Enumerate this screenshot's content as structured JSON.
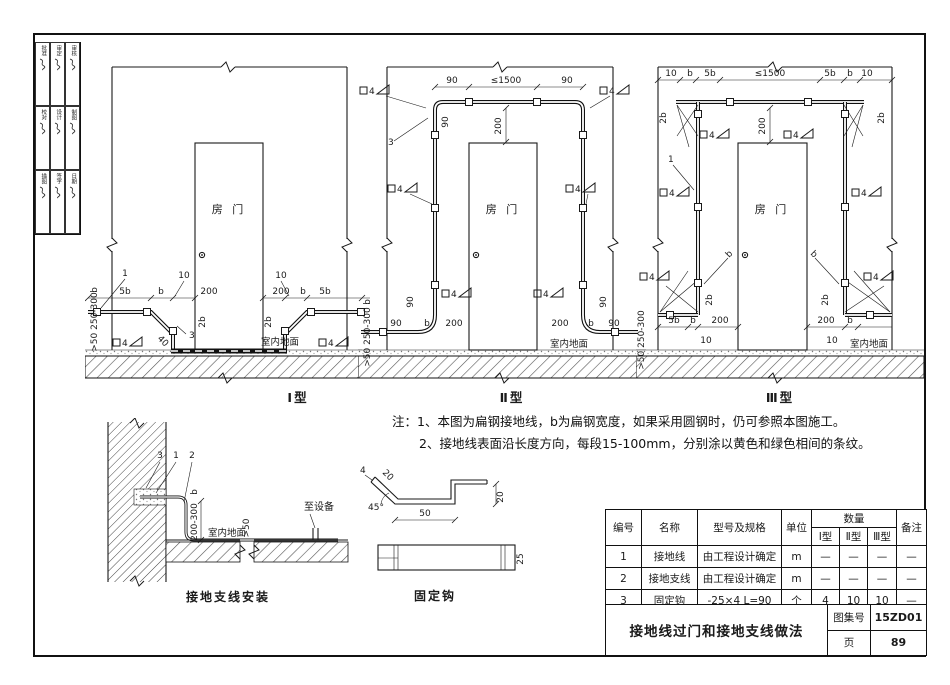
{
  "colors": {
    "ink": "#1a1a1a",
    "paper": "#ffffff"
  },
  "sidebar": {
    "cells": [
      "批准",
      "审定",
      "审核",
      "校对",
      "设计",
      "制图",
      "描图",
      "签字",
      "日期"
    ]
  },
  "dims": {
    "n1": "1",
    "n2": "2",
    "n3": "3",
    "b": "b",
    "b2": "2b",
    "b5": "5b",
    "d4": "4",
    "d10": "10",
    "d20": "20",
    "d25": "25",
    "d40": "40",
    "d45": "45°",
    "d50": "50",
    "d90": "90",
    "d200": "200",
    "max1500": "≤1500",
    "depth": ">50 250-300",
    "range": "200-300",
    "gt50": ">50"
  },
  "labels": {
    "door": "房 门",
    "floor": "室内地面",
    "type1": "Ⅰ型",
    "type2": "Ⅱ型",
    "type3": "Ⅲ型",
    "to_equipment": "至设备",
    "install_caption": "接地支线安装",
    "hook_caption": "固定钩"
  },
  "notes": {
    "line1": "注：1、本图为扁钢接地线，b为扁钢宽度，如果采用圆钢时，仍可参照本图施工。",
    "line2": "2、接地线表面沿长度方向，每段15-100mm，分别涂以黄色和绿色相间的条纹。"
  },
  "table": {
    "headers": {
      "no": "编号",
      "name": "名称",
      "spec": "型号及规格",
      "unit": "单位",
      "qty": "数量",
      "remark": "备注",
      "t1": "Ⅰ型",
      "t2": "Ⅱ型",
      "t3": "Ⅲ型"
    },
    "rows": [
      {
        "no": "1",
        "name": "接地线",
        "spec": "由工程设计确定",
        "unit": "m",
        "q1": "—",
        "q2": "—",
        "q3": "—",
        "remark": "—"
      },
      {
        "no": "2",
        "name": "接地支线",
        "spec": "由工程设计确定",
        "unit": "m",
        "q1": "—",
        "q2": "—",
        "q3": "—",
        "remark": "—"
      },
      {
        "no": "3",
        "name": "固定钩",
        "spec": "-25×4  L=90",
        "unit": "个",
        "q1": "4",
        "q2": "10",
        "q3": "10",
        "remark": "—"
      }
    ]
  },
  "titleblock": {
    "title": "接地线过门和接地支线做法",
    "atlas_label": "图集号",
    "atlas_no": "15ZD01",
    "page_label": "页",
    "page_no": "89"
  }
}
